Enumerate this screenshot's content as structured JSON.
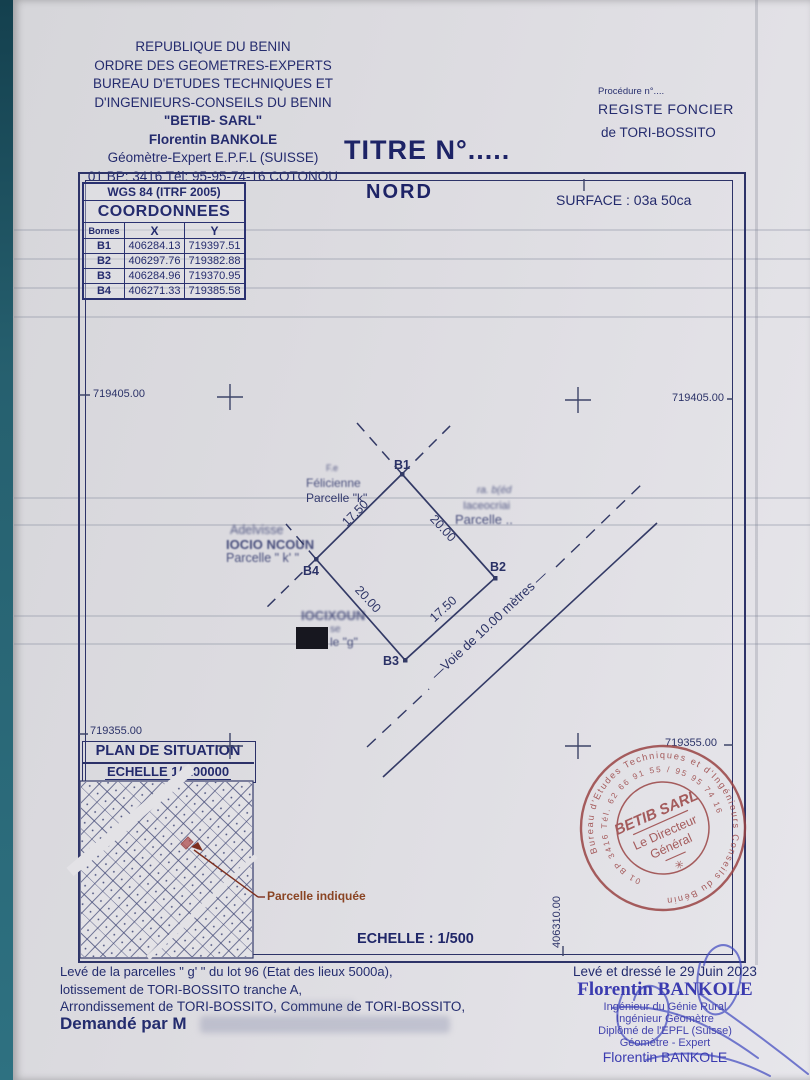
{
  "letterhead": {
    "l1": "REPUBLIQUE DU BENIN",
    "l2": "ORDRE DES GEOMETRES-EXPERTS",
    "l3": "BUREAU D'ETUDES TECHNIQUES ET",
    "l4": "D'INGENIEURS-CONSEILS DU BENIN",
    "l5": "\"BETIB- SARL\"",
    "l6": "Florentin BANKOLE",
    "l7": "Géomètre-Expert E.P.F.L (SUISSE)",
    "l8": "01 BP: 3416 Tél: 95-95-74-16 COTONOU"
  },
  "title": "TITRE N°.....",
  "registry": {
    "procedure": "Procédure n°....",
    "line1": "REGISTE FONCIER",
    "line2": "de TORI-BOSSITO"
  },
  "plan": {
    "north": "NORD",
    "surface": "SURFACE : 03a 50ca",
    "scale": "ECHELLE : 1/500",
    "grid": {
      "nw": "719405.00",
      "ne": "719405.00",
      "sw": "719355.00",
      "se": "719355.00",
      "south_easting": "406310.00"
    },
    "parcel": {
      "b1": "B1",
      "b2": "B2",
      "b3": "B3",
      "b4": "B4",
      "side_b4b1": "17.50",
      "side_b1b2": "20.00",
      "side_b4b3": "20.00",
      "side_b3b2": "17.50",
      "road": "—Voie  de  10.00 mètres —"
    },
    "neighbors": {
      "nw_note": "F.e",
      "nw_name": "Félicienne",
      "nw_parcel": "Parcelle \"k\"",
      "w_line1": "Adelvisse",
      "w_line2": "IOCIO NCOUN",
      "w_line3": "Parcelle \" k' \"",
      "e_line1": "ra. b(éd",
      "e_line2": "Iaceocriai",
      "e_line3": "Parcelle ..",
      "s_line1": "IOCIXOUN",
      "s_line2": "se",
      "s_line3": "le \"g\""
    },
    "situation": {
      "title": "PLAN DE SITUATION",
      "scale": "ECHELLE 1/ 100000",
      "callout": "Parcelle indiquée"
    }
  },
  "coords_table": {
    "system": "WGS 84 (ITRF 2005)",
    "title": "COORDONNEES",
    "headers": [
      "Bornes",
      "X",
      "Y"
    ],
    "rows": [
      [
        "B1",
        "406284.13",
        "719397.51"
      ],
      [
        "B2",
        "406297.76",
        "719382.88"
      ],
      [
        "B3",
        "406284.96",
        "719370.95"
      ],
      [
        "B4",
        "406271.33",
        "719385.58"
      ]
    ]
  },
  "stamp": {
    "ring_outer": "Bureau d'Etudes Techniques et d'Ingénieurs Conseils du Bénin",
    "ring_inner": "01 BP 3416 Tél. 62 66 91 55 / 95 95 74 16",
    "name": "BETIB SARL",
    "role1": "Le Directeur",
    "role2": "Général",
    "flower": "✳"
  },
  "footer": {
    "left1": "Levé de la  parcelles \" g' \" du lot 96 (Etat des lieux 5000a),",
    "left2": "lotissement de TORI-BOSSITO tranche A,",
    "left3": "Arrondissement de TORI-BOSSITO, Commune  de TORI-BOSSITO,",
    "left4": "Demandé par M",
    "date": "Levé et dressé le 29 Juin 2023",
    "name": "Florentin BANKOLE",
    "title1": "Ingénieur du Génie Rural",
    "title2": "Ingénieur Géomètre",
    "title3": "Diplômé de l'EPFL (Suisse)",
    "title4": "Géomètre - Expert",
    "name2": "Florentin BANKOLE"
  },
  "colors": {
    "ink": "#242b6e",
    "drawing_line": "#333a66",
    "stamp_red": "#9a4444",
    "callout_red": "#8a4423",
    "signature_blue": "#3f48c0",
    "paper": "#dddce1",
    "backdrop_teal": "#26606f"
  }
}
